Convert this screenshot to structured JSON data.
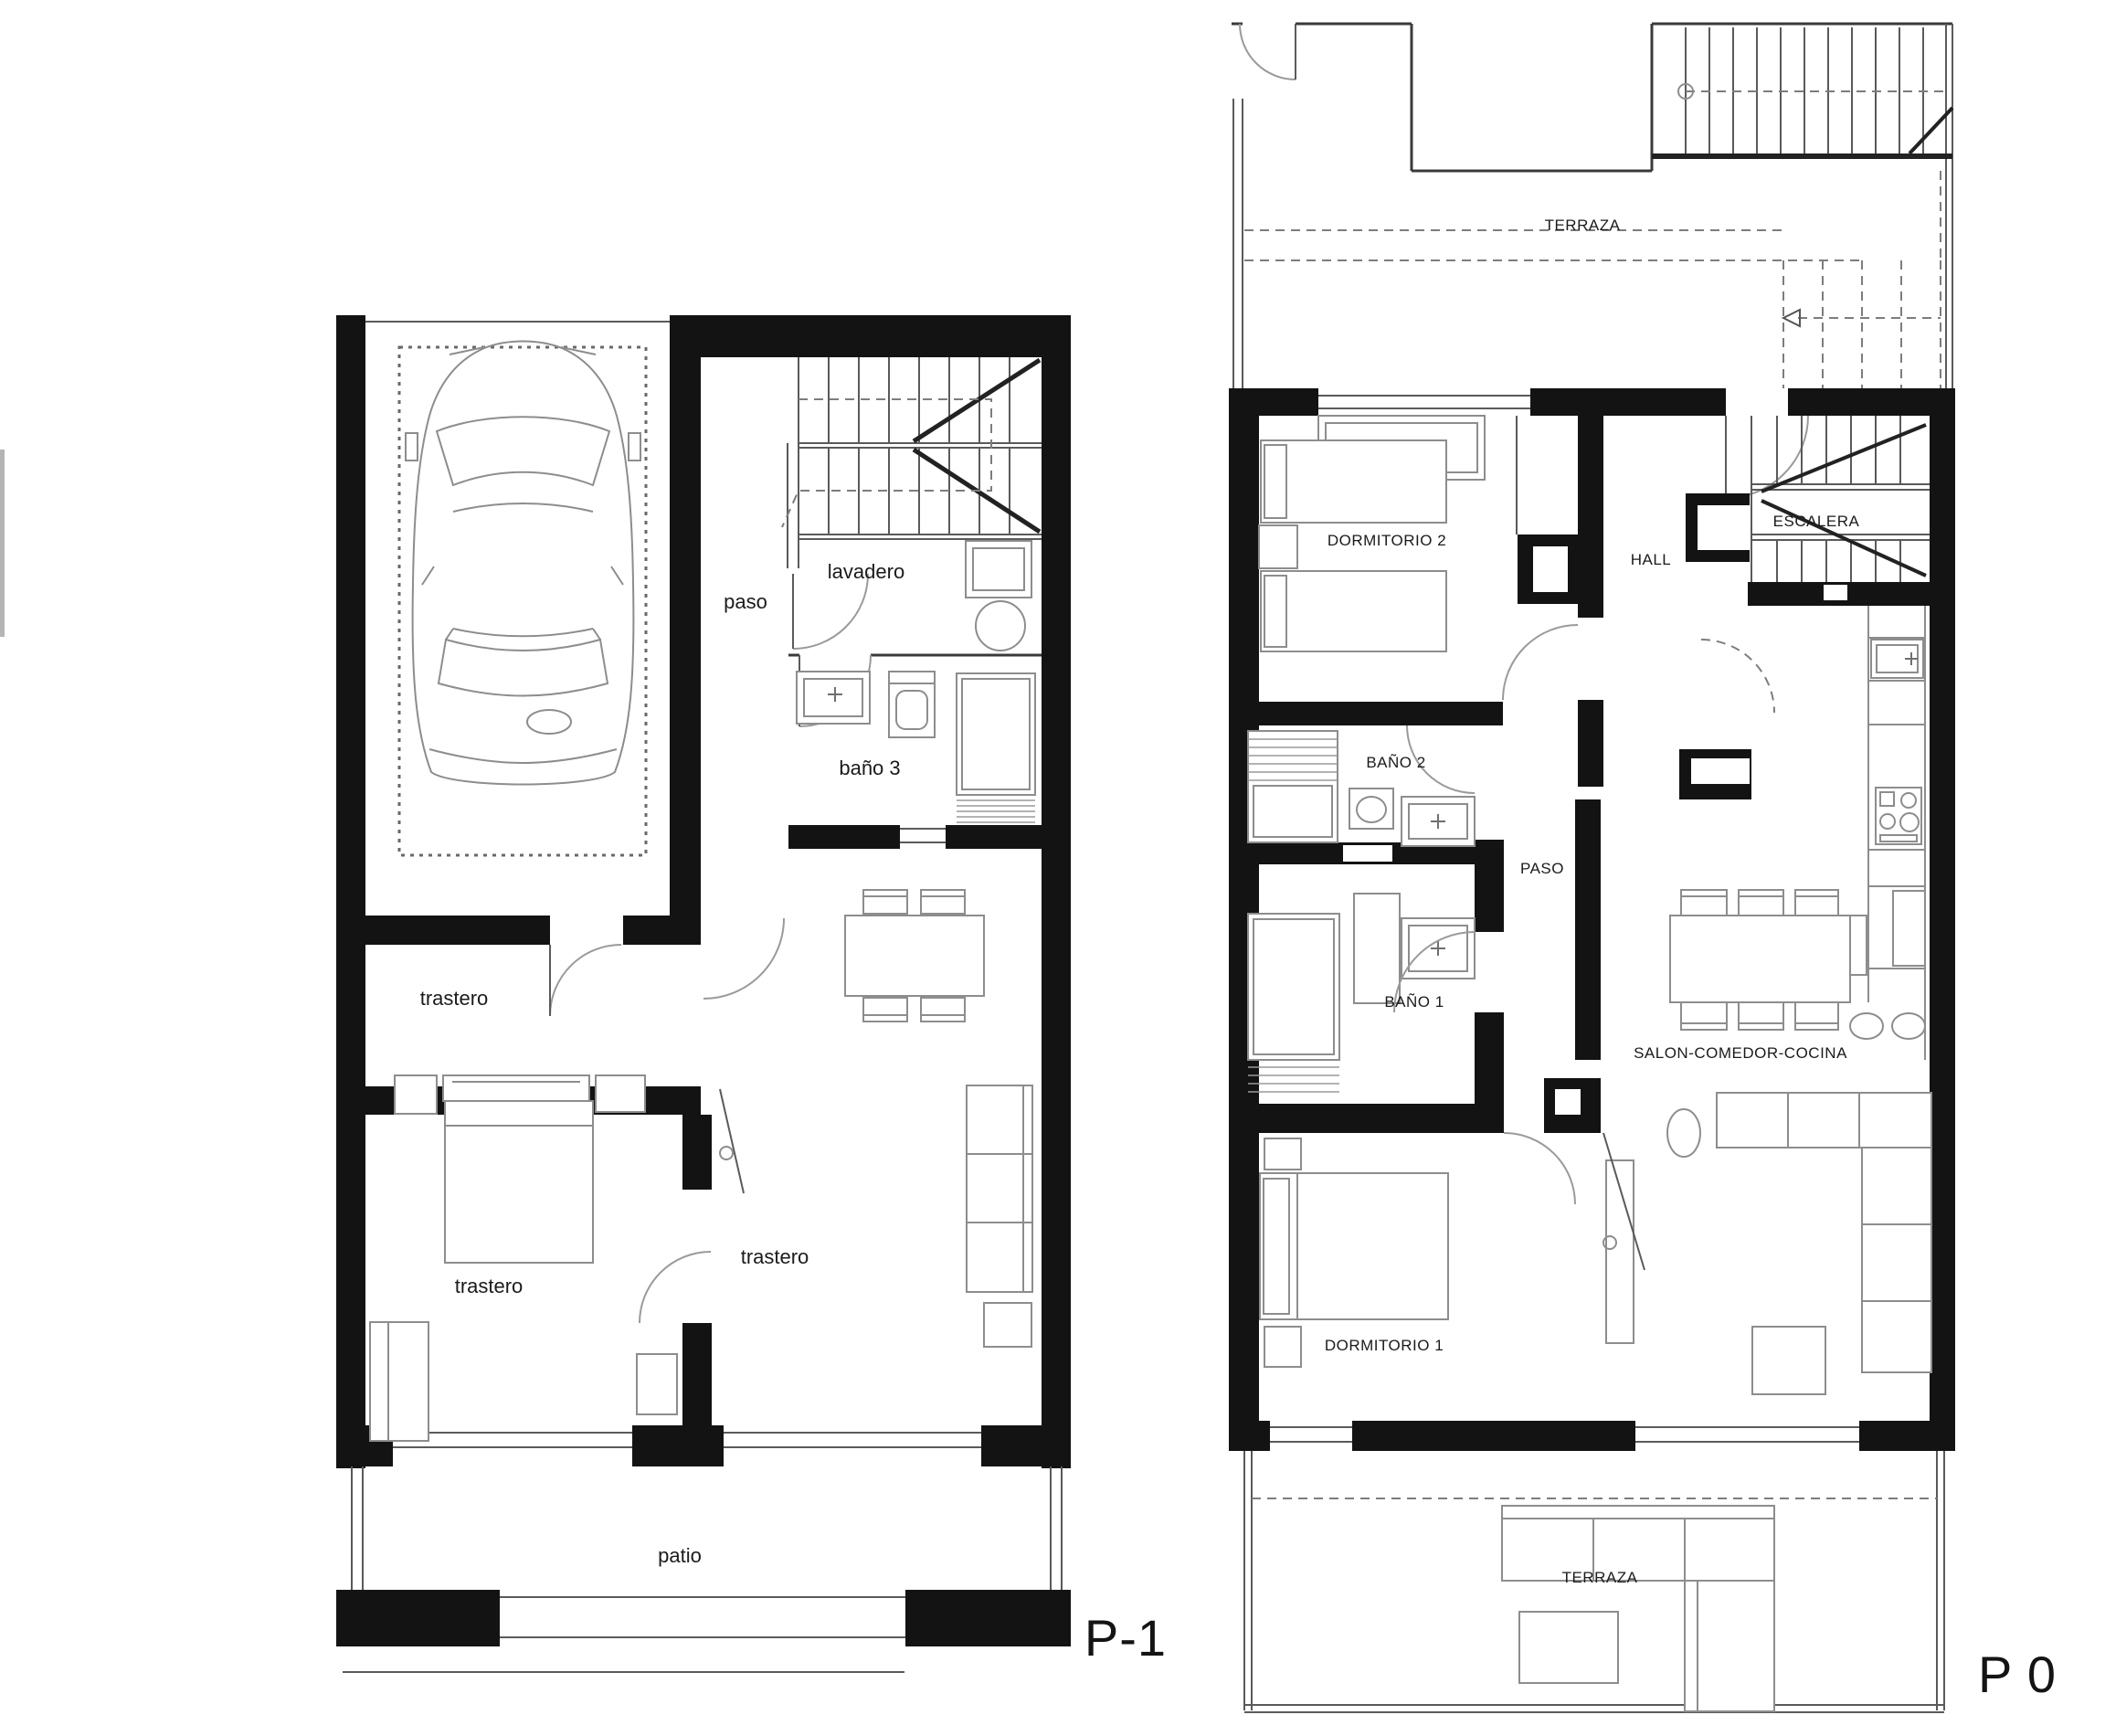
{
  "document": {
    "kind": "architectural floor plan drawing",
    "background_color": "#ffffff",
    "wall_color": "#131313",
    "furniture_line_color": "#8d8d8d",
    "label_color": "#1b1b1b"
  },
  "plans": {
    "p1": {
      "title": "P-1",
      "labels": {
        "paso": "paso",
        "lavadero": "lavadero",
        "bano3": "baño 3",
        "trastero_a": "trastero",
        "trastero_b": "trastero",
        "trastero_c": "trastero",
        "patio": "patio"
      },
      "icons": [
        "car-icon",
        "stairs-icon",
        "washer-icon",
        "round-sink-icon",
        "sink-icon",
        "toilet-icon",
        "shower-icon",
        "dining-table-icon",
        "sofa-icon",
        "double-bed-icon",
        "wardrobe-icon",
        "desk-icon"
      ]
    },
    "p0": {
      "title": "P 0",
      "labels": {
        "terraza_top": "TERRAZA",
        "dormitorio2": "DORMITORIO 2",
        "hall": "HALL",
        "escalera": "ESCALERA",
        "bano2": "BAÑO 2",
        "paso": "PASO",
        "bano1": "BAÑO 1",
        "salon": "SALON-COMEDOR-COCINA",
        "dormitorio1": "DORMITORIO 1",
        "terraza_bottom": "TERRAZA"
      },
      "icons": [
        "stairs-icon",
        "twin-beds-icon",
        "wardrobe-icon",
        "shower-icon",
        "sink-icon",
        "toilet-icon",
        "kitchen-counter-icon",
        "stove-icon",
        "dining-table-icon",
        "stools-icon",
        "sofa-icon",
        "coffee-table-icon",
        "plant-icon",
        "double-bed-icon",
        "outdoor-sofa-icon",
        "outdoor-table-icon"
      ]
    }
  }
}
